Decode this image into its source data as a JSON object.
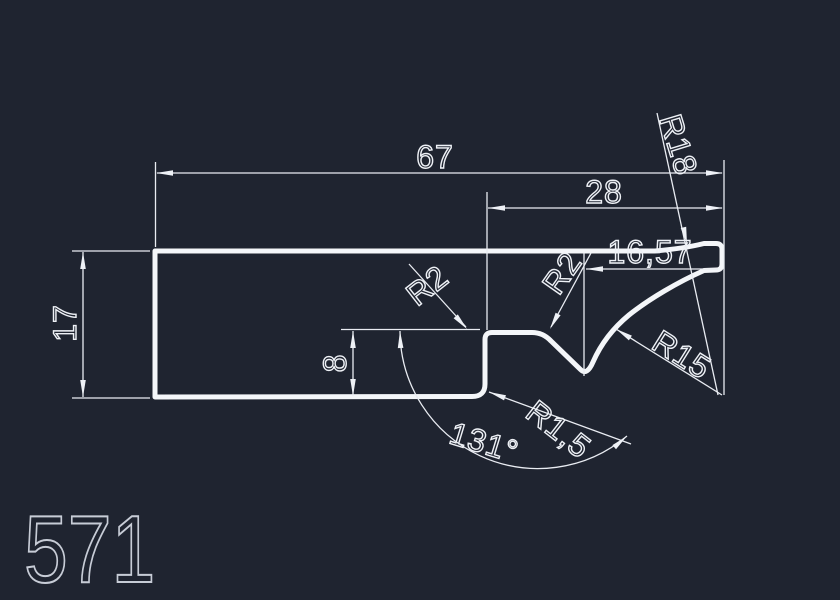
{
  "drawing": {
    "part_number": "571",
    "dims": {
      "total_width": "67",
      "right_width": "28",
      "left_height": "17",
      "step_height": "8",
      "end_length": "16,57",
      "radius_top_arc": "R18",
      "radius_concave_arc": "R15",
      "radius_step_fillet": "R2",
      "radius_shoulder_fillet": "R2",
      "radius_bottom_fillet": "R1,5",
      "groove_angle": "131°"
    }
  },
  "colors": {
    "background": "#1f2430",
    "outline": "#f4f6f9",
    "dimension_lines": "#e9ecf2",
    "part_number_text": "#c7ccd6"
  }
}
